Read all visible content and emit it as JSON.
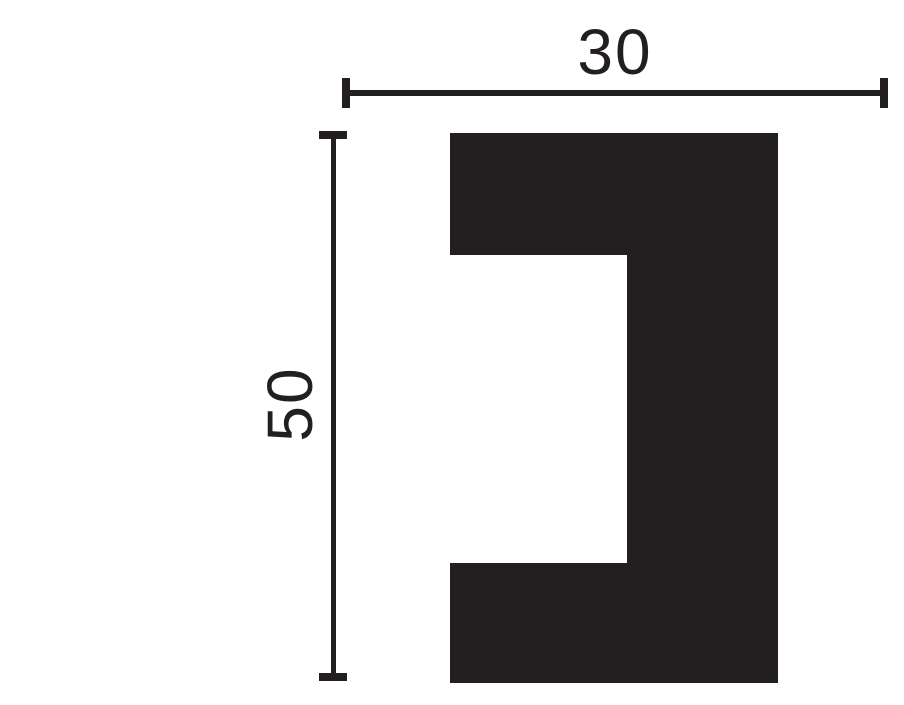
{
  "drawing": {
    "type": "molding-profile-cross-section",
    "width_dimension": {
      "label": "30",
      "value": 30
    },
    "height_dimension": {
      "label": "50",
      "value": 50
    },
    "colors": {
      "ink": "#231f20",
      "background": "#ffffff"
    }
  }
}
